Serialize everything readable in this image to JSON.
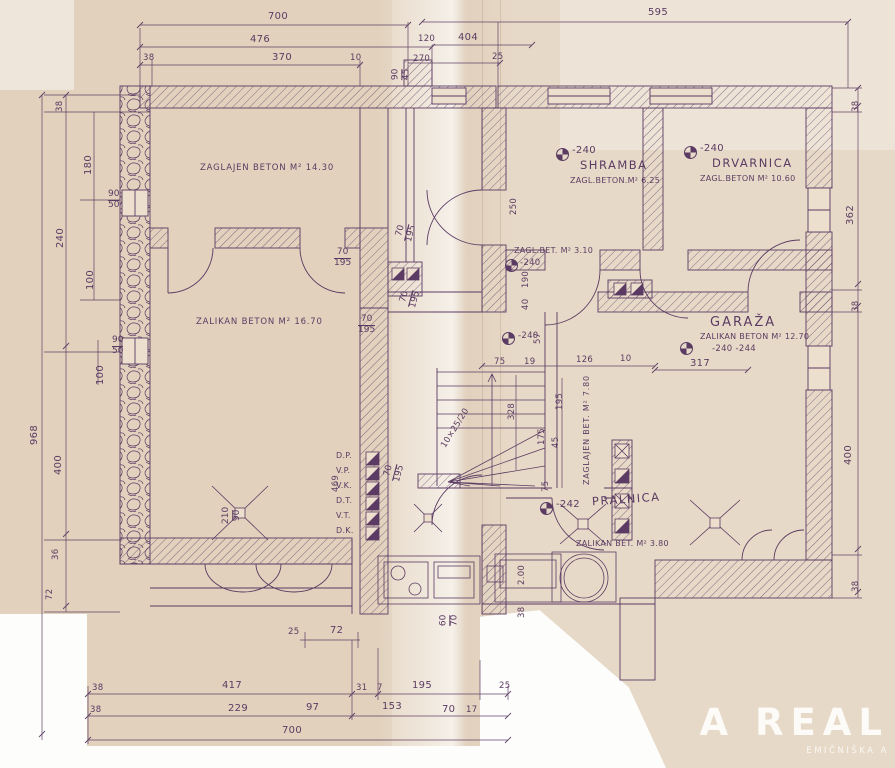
{
  "colors": {
    "ink": "#5b3b63",
    "paper": "#e7d9c7"
  },
  "watermark": {
    "line1": "A REAL",
    "line2": "EMIČNIŠKA A"
  },
  "levels": {
    "l240": "-240",
    "l242": "-242",
    "l240_244": "-240 -244"
  },
  "rooms": {
    "nw_area": "ZAGLAJEN BETON M² 14.30",
    "sw_area": "ZALIKAN BETON M² 16.70",
    "shramba_name": "SHRAMBA",
    "shramba_area": "ZAGL.BETON.M² 6.25",
    "drvarnica_name": "DRVARNICA",
    "drvarnica_area": "ZAGL.BETON M² 10.60",
    "hall_area": "ZAGL.BET. M² 3.10",
    "garaza_name": "GARAŽA",
    "garaza_area": "ZALIKAN BETON M² 12.70",
    "stairhall_area": "ZAGLAJEN BET. M² 7.80",
    "pralnica_name": "PRALNICA",
    "pralnica_area": "ZALIKAN BET. M² 3.80"
  },
  "stairs_note": "10×25/20",
  "shafts": {
    "s1": "D.P.",
    "s2": "V.P.",
    "s3": "V.K.",
    "s4": "D.T.",
    "s5": "V.T.",
    "s6": "D.K."
  },
  "door": {
    "w": "70",
    "h": "195"
  },
  "w9050": {
    "w": "90",
    "h": "50"
  },
  "w9045": {
    "w": "90",
    "h": "45"
  },
  "w6070": {
    "w": "60",
    "h": "70"
  },
  "w21090": {
    "w": "210",
    "h": "90"
  },
  "dims": {
    "t700": "700",
    "t595": "595",
    "t476": "476",
    "t120": "120",
    "t404": "404",
    "t38": "38",
    "t370": "370",
    "t10": "10",
    "t270": "270",
    "t25": "25",
    "l38": "38",
    "l180": "180",
    "l100a": "100",
    "l100b": "100",
    "l240": "240",
    "l968": "968",
    "l400": "400",
    "l36": "36",
    "l72": "72",
    "r38a": "38",
    "r362": "362",
    "r38b": "38",
    "r400": "400",
    "r38c": "38",
    "b38a": "38",
    "b417": "417",
    "b31": "31",
    "b7": "7",
    "b195": "195",
    "b25": "25",
    "b38b": "38",
    "b229": "229",
    "b97": "97",
    "b153": "153",
    "b70": "70",
    "b17": "17",
    "b700": "700",
    "m25": "25",
    "m72": "72",
    "m38": "38",
    "i190": "190",
    "i40": "40",
    "i57": "57",
    "i75a": "75",
    "i19": "19",
    "i126": "126",
    "i10": "10",
    "i328": "328",
    "i195": "195",
    "i175": "175",
    "i45": "45",
    "i75b": "75",
    "i469": "469",
    "i200": "2.00",
    "i317": "317",
    "i250": "250"
  }
}
